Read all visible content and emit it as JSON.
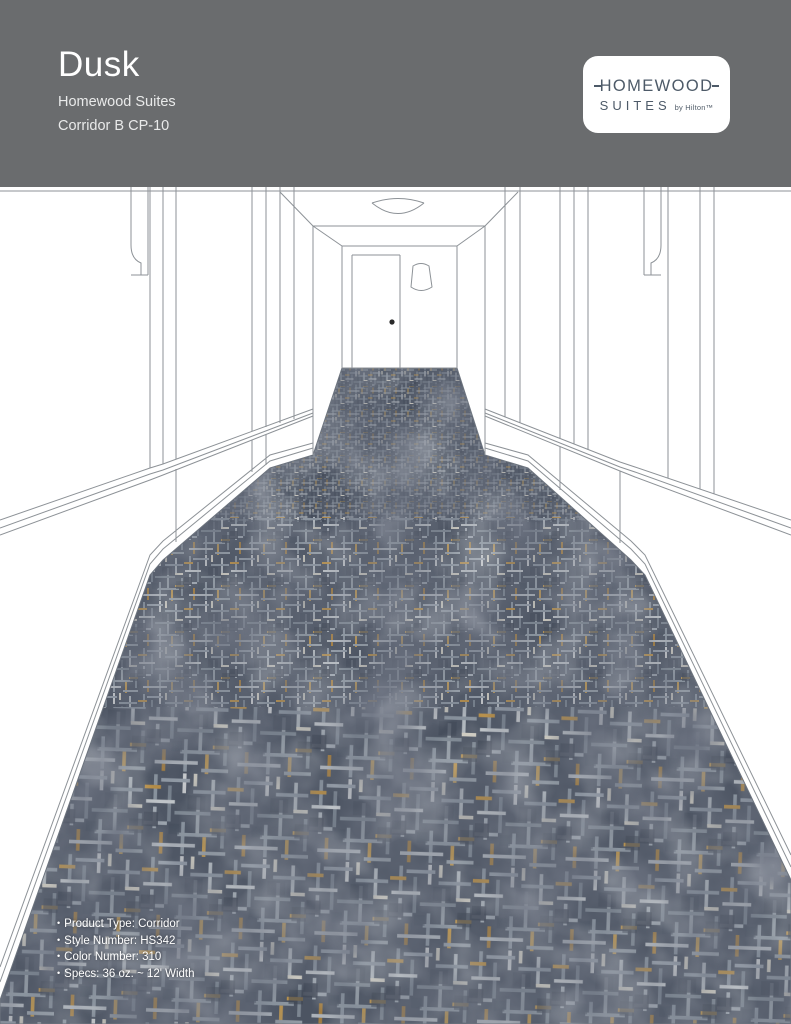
{
  "header": {
    "background": "#6a6c6e",
    "title": "Dusk",
    "subtitle_line1": "Homewood Suites",
    "subtitle_line2": "Corridor B CP-10",
    "logo": {
      "line1": "HOMEWOOD",
      "line2": "SUITES",
      "byline": "by Hilton™",
      "text_color": "#4d5a68",
      "background": "#ffffff"
    }
  },
  "rendering": {
    "description": "One-point perspective line drawing of a hotel corridor with an end door, ceiling light and patterned carpet",
    "carpet_colors": {
      "base": "#4c5462",
      "dark_mottle": "#3d4452",
      "light_accent": "#c8cccf",
      "gold_accent": "#c79a4a"
    },
    "line_color": "#8d9297"
  },
  "specs": {
    "bullet": "•",
    "text_color": "#ffffff",
    "items": [
      "Product Type: Corridor",
      "Style Number: HS342",
      "Color Number: 310",
      "Specs: 36 oz. ~ 12' Width"
    ]
  }
}
